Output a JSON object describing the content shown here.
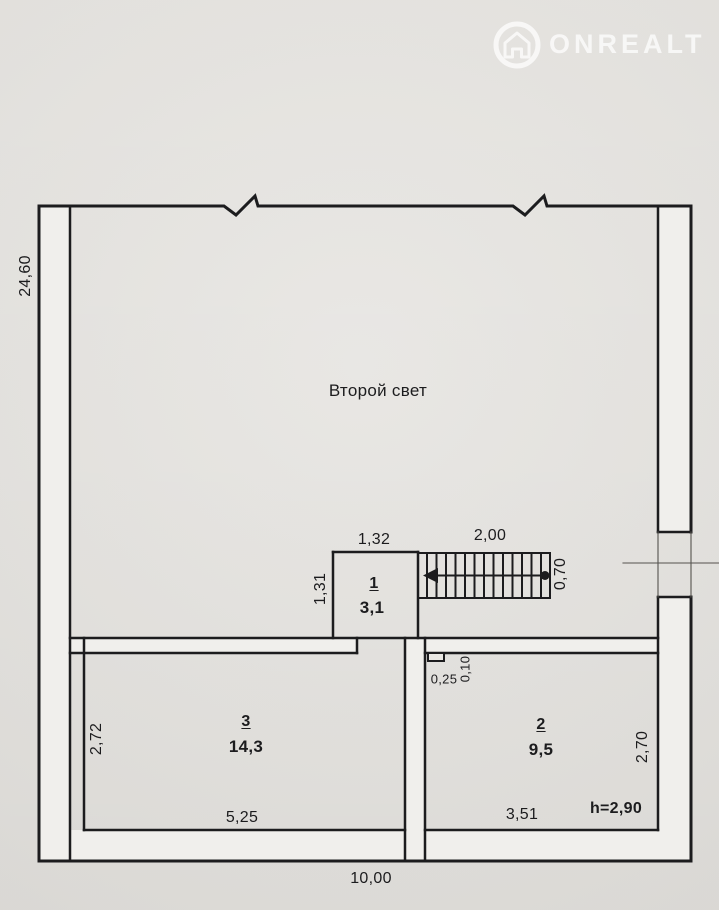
{
  "watermark": {
    "brand": "ONREALT"
  },
  "plan": {
    "second_light": "Второй свет",
    "room1": {
      "number": "1",
      "area": "3,1"
    },
    "room2": {
      "number": "2",
      "area": "9,5"
    },
    "room3": {
      "number": "3",
      "area": "14,3"
    },
    "dims": {
      "left_total": "24,60",
      "bottom_total": "10,00",
      "room1_w": "1,32",
      "room1_h": "1,31",
      "stair_len": "2,00",
      "stair_w": "0,70",
      "stub_w": "0,25",
      "stub_d": "0,10",
      "room3_h": "2,72",
      "room3_w": "5,25",
      "room2_w": "3,51",
      "room2_h": "2,70",
      "ceiling": "h=2,90"
    }
  },
  "colors": {
    "paper": "#e9e7e3",
    "line": "#1c1c1e",
    "wall_fill": "#f0efec",
    "watermark": "#ffffff"
  }
}
